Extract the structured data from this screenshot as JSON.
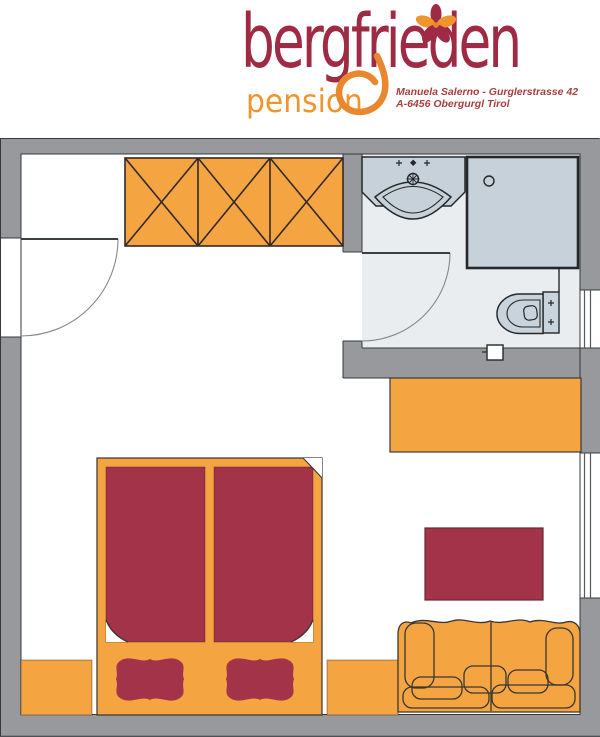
{
  "logo": {
    "brand": "bergfrieden",
    "subbrand": "pension",
    "address_line1": "Manuela Salerno - Gurglerstrasse 42",
    "address_line2": "A-6456 Obergurgl Tirol"
  },
  "colors": {
    "brand_red": "#9E2B43",
    "brand_orange": "#F0952D",
    "loop_orange": "#E8872E",
    "furniture_orange": "#F4A542",
    "furniture_red": "#A23348",
    "wall_gray": "#97999C",
    "bathroom_floor": "#E9EDEF",
    "fixture_fill": "#C7D2DA",
    "line_dark": "#2F3438"
  },
  "floorplan": {
    "rooms": [
      "bedroom",
      "bathroom"
    ],
    "elements": [
      "wardrobe",
      "entry-door",
      "bathroom-door",
      "washbasin",
      "shower",
      "toilet",
      "window-bathroom",
      "window-bedroom",
      "desk",
      "double-bed",
      "mattress-left",
      "mattress-right",
      "foot-cushion-left",
      "foot-cushion-right",
      "bench-left",
      "bench-right",
      "coffee-table",
      "sofa"
    ]
  }
}
